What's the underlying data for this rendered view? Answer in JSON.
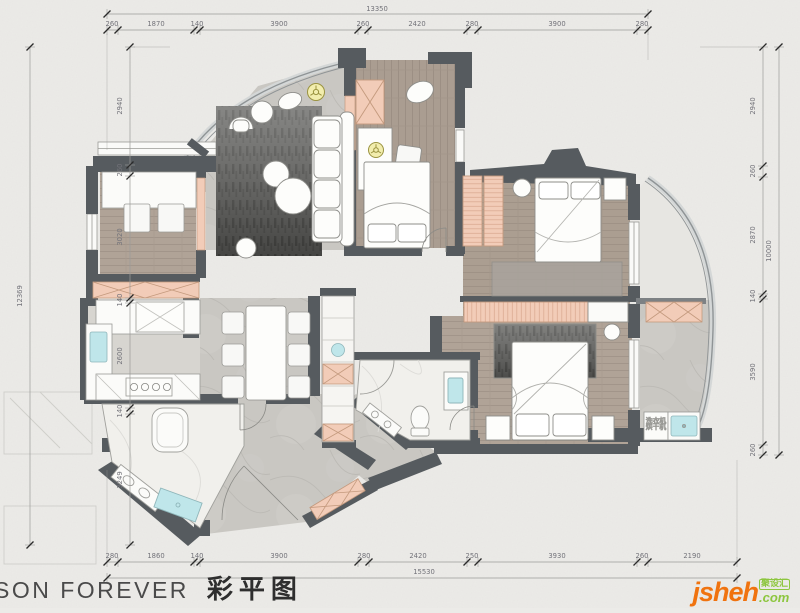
{
  "page": {
    "title_brand": "SON FOREVER",
    "title_cn": "彩平图"
  },
  "logo": {
    "name": "jsheh",
    "tld": ".com",
    "badge": "聚设汇"
  },
  "dimensions": {
    "top": {
      "total": "13350",
      "segments": [
        "260",
        "1870",
        "140",
        "3900",
        "260",
        "2420",
        "280",
        "3900",
        "280"
      ]
    },
    "bottom": {
      "total": "15530",
      "segments": [
        "280",
        "1860",
        "140",
        "3900",
        "280",
        "2420",
        "250",
        "3930",
        "260",
        "2190"
      ]
    },
    "left": {
      "total": "12369",
      "segments": [
        "2940",
        "260",
        "3020",
        "140",
        "2600",
        "140",
        "3249"
      ]
    },
    "right": {
      "total": "10000",
      "segments": [
        "2940",
        "260",
        "2870",
        "140",
        "3590",
        "260"
      ]
    }
  },
  "annotations": {
    "laundry_line1": "洗衣机",
    "laundry_line2": "烘干机"
  },
  "colors": {
    "paper": "#ecebe8",
    "wall": "#565b5f",
    "wood": "#b0a397",
    "stone": "#c9c7c2",
    "marble": "#f1f0ec",
    "pink": "#f2ccb8",
    "pink_line": "#d9a68e",
    "aqua": "#bfe6ea",
    "fan_yellow": "#f2edad",
    "rug_dark": "#555553",
    "dim_text": "#73737a",
    "logo_orange": "#f0730f",
    "logo_green": "#8dc63f"
  }
}
